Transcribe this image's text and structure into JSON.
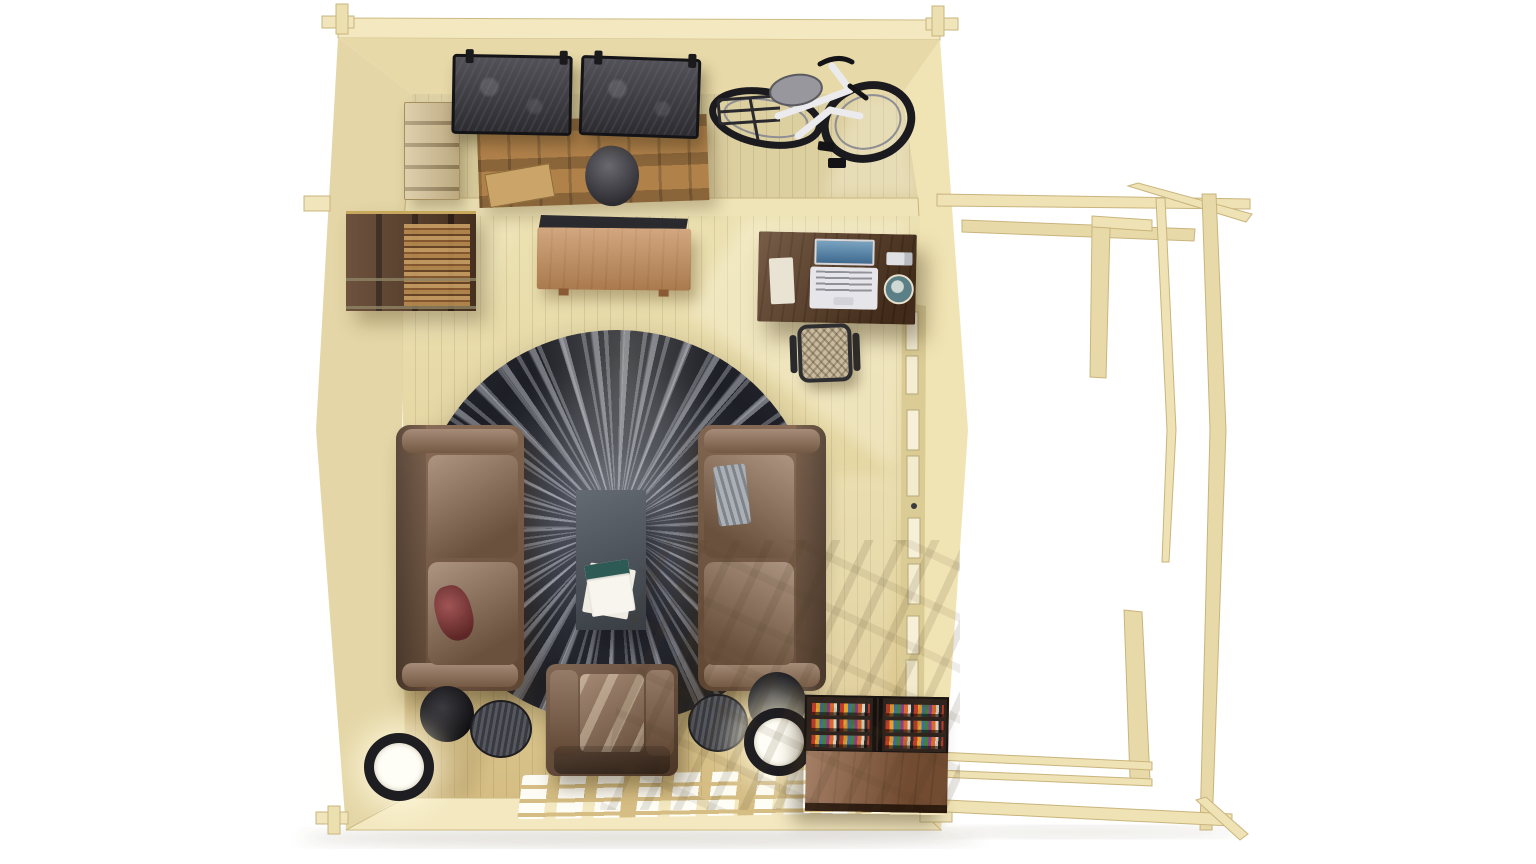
{
  "meta": {
    "description": "Top-down 3D render of a wooden log cabin interior: a storage room with hanging canvas bins, wooden pallet, crate and a wall-mounted bicycle; a living room with wall shelf, TV with sideboard, walnut desk with laptop, office chair, round shaggy rug, two facing leather sofas, slate coffee table, leather armchair, floor lamps, side tables and a book cabinet; an open timber pergola frame attached to the right side; sunlight grid patches on the floor.",
    "view": "orthographic top-down",
    "visible_text": ""
  },
  "palette": {
    "bg": "#ffffff",
    "wall_top": "#f3e8c0",
    "wall_face": "#e8d9a8",
    "wall_face_left": "#e4d6a6",
    "wall_sunlit": "#f1e4b4",
    "divider": "#efe4b8",
    "storage_floor": "#dccfa0",
    "floor_top": "#ebe0b1",
    "floor_bottom": "#d5bd83",
    "window_frame": "#dbcc96",
    "window_pane": "#f7f0d8",
    "pergola_wood": "#efe2b4",
    "pergola_edge": "#c9b47c",
    "crate": "#d5c092",
    "pallet": "#b1814a",
    "bin_canvas": "#44434a",
    "bin_frame": "#141417",
    "bike_frame": "#ebebee",
    "bike_tire": "#1b1b1f",
    "bike_saddle": "#97979d",
    "shelf_walnut": "#5c3e28",
    "tv_black": "#2b2b2f",
    "sideboard": "#c68e5b",
    "desk_walnut": "#5e3e24",
    "chair_mesh": "#c9ba9c",
    "chair_frame": "#303033",
    "rug_base": "#2b2d35",
    "rug_streak": "#c0c2ca",
    "coffee_table": "#4b525b",
    "sofa_leather": "#7a5a42",
    "sofa_cushion": "#8d6c52",
    "pillow_red": "#7d3838",
    "blanket_gray": "#9aa0a6",
    "armchair_leather": "#6b4c36",
    "lamp_ring": "#1e1d21",
    "lamp_glow": "#fffdf2",
    "disc_black": "#202024",
    "side_table_gray": "#4a4c53",
    "bookcase_frame": "#2e231d",
    "cabinet_wood": "#8b5c3c",
    "sun_light": "#fffbe8"
  },
  "book_spine_colors": [
    "#c23b2a",
    "#e0a32e",
    "#3a6fae",
    "#47803c",
    "#8e3b8e",
    "#d96a2b",
    "#d9d2c2",
    "#2b2b2b"
  ],
  "scene": {
    "storage_room": {
      "objects": [
        {
          "id": "wooden-crate",
          "label": "tall wooden crate"
        },
        {
          "id": "wooden-pallet",
          "label": "leaning wooden pallet"
        },
        {
          "id": "canvas-bins",
          "label": "two dark canvas storage bins hung on wall rail"
        },
        {
          "id": "bicycle",
          "label": "white city bicycle wall-mounted"
        },
        {
          "id": "sack",
          "label": "gray fabric sack"
        }
      ]
    },
    "living_room": {
      "objects": [
        {
          "id": "wall-shelf",
          "label": "walnut wall shelf with books"
        },
        {
          "id": "tv",
          "label": "flat TV mounted on partition wall"
        },
        {
          "id": "sideboard",
          "label": "oak sideboard"
        },
        {
          "id": "desk",
          "label": "walnut desk with laptop, notepad, phone and plant"
        },
        {
          "id": "office-chair",
          "label": "mesh office chair"
        },
        {
          "id": "rug",
          "label": "round black-and-gray shaggy rug"
        },
        {
          "id": "coffee-table",
          "label": "slate gray coffee table with magazine"
        },
        {
          "id": "sofa-left",
          "label": "brown leather sofa with red pillow"
        },
        {
          "id": "sofa-right",
          "label": "brown leather sofa with gray blanket"
        },
        {
          "id": "armchair",
          "label": "brown leather armchair"
        },
        {
          "id": "floor-lamps",
          "label": "two glowing drum floor lamps"
        },
        {
          "id": "side-tables",
          "label": "round black and striped side tables"
        },
        {
          "id": "book-cabinet",
          "label": "low cabinet with two book racks of colorful books"
        },
        {
          "id": "glazed-door-light",
          "label": "sunlight grid cast through glazed door"
        }
      ]
    },
    "exterior": {
      "objects": [
        {
          "id": "pergola",
          "label": "open timber pergola frame attached to right wall"
        },
        {
          "id": "glazed-wall",
          "label": "right wall glazed doors with handle"
        }
      ]
    },
    "floor_light_grid": {
      "rows": 3,
      "cols": 9,
      "groups": 3
    }
  }
}
